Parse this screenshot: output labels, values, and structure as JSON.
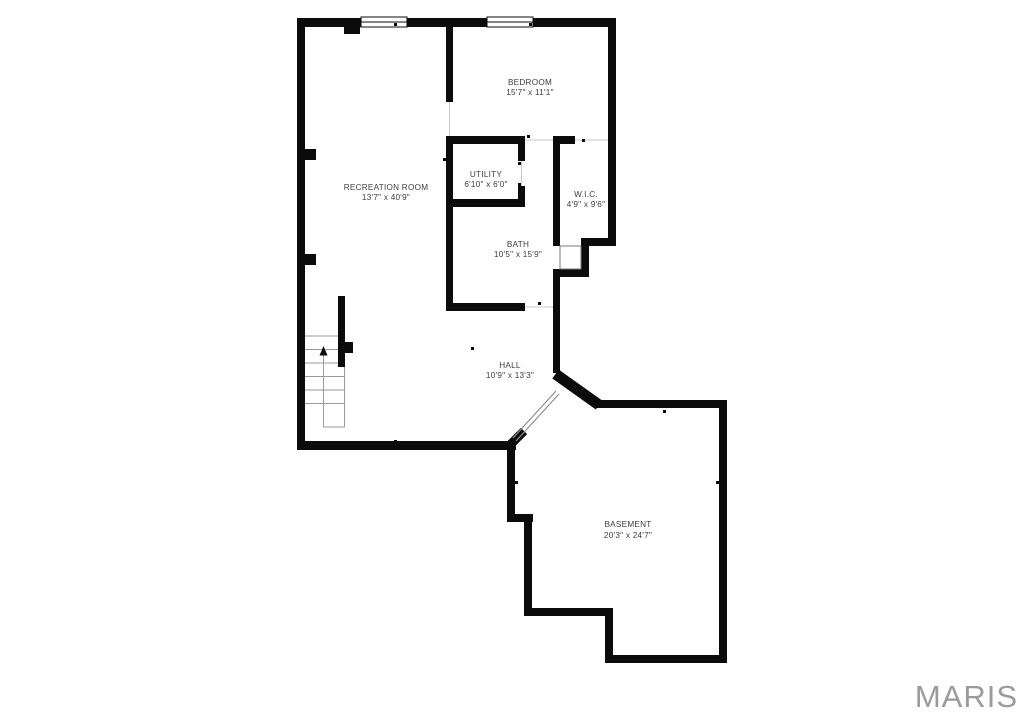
{
  "watermark": {
    "text": "MARIS"
  },
  "rooms": {
    "recreation": {
      "name": "RECREATION ROOM",
      "dims": "13'7\" x 40'9\""
    },
    "bedroom": {
      "name": "BEDROOM",
      "dims": "15'7\" x 11'1\""
    },
    "utility": {
      "name": "UTILITY",
      "dims": "6'10\" x 6'0\""
    },
    "wic": {
      "name": "W.I.C.",
      "dims": "4'9\" x 9'6\""
    },
    "bath": {
      "name": "BATH",
      "dims": "10'5\" x 15'9\""
    },
    "hall": {
      "name": "HALL",
      "dims": "10'9\" x 13'3\""
    },
    "basement": {
      "name": "BASEMENT",
      "dims": "20'3\" x 24'7\""
    }
  },
  "colors": {
    "bg": "#ffffff",
    "wall": "#0b0b0b",
    "label": "#3d3d3d",
    "stairs": "#9a9a9a",
    "watermark": "#9b9b9b"
  }
}
